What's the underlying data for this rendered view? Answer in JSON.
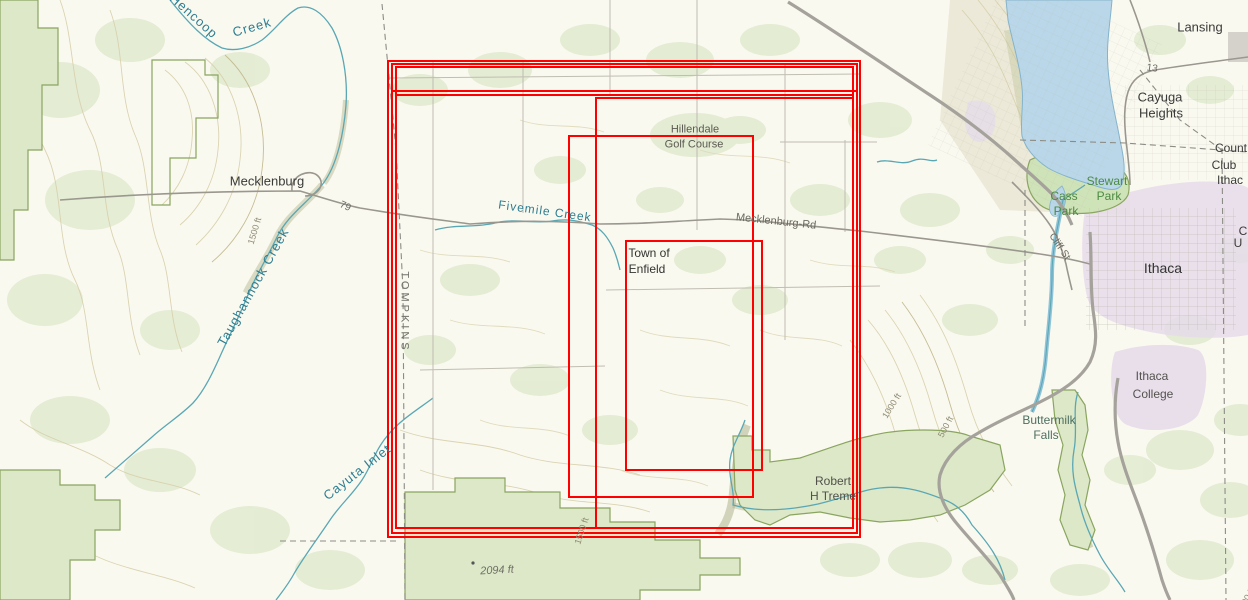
{
  "overlay": {
    "accent_color": "#ff0000",
    "rectangles": [
      {
        "x": 387,
        "y": 60,
        "w": 474,
        "h": 478
      },
      {
        "x": 391,
        "y": 63,
        "w": 467,
        "h": 471
      },
      {
        "x": 395,
        "y": 66,
        "w": 459,
        "h": 463
      },
      {
        "x": 391,
        "y": 90,
        "w": 467,
        "h": 444
      },
      {
        "x": 395,
        "y": 94,
        "w": 459,
        "h": 435
      },
      {
        "x": 595,
        "y": 97,
        "w": 259,
        "h": 432
      },
      {
        "x": 568,
        "y": 135,
        "w": 186,
        "h": 363
      },
      {
        "x": 625,
        "y": 240,
        "w": 138,
        "h": 231
      }
    ]
  },
  "basemap_colors": {
    "water": "#b9d7e8",
    "vegetation": "#e2ebd1",
    "park_outline": "#8aa55f",
    "contour": "#d7d0ab",
    "urban_tint": "#e6dcea",
    "road": "#a5a29b"
  },
  "labels": [
    {
      "id": "hencoop-creek-1",
      "text": "Hencoop",
      "x": 194,
      "y": 16,
      "rot": 42,
      "color": "#2e7d91",
      "size": 13,
      "spacing": 1
    },
    {
      "id": "hencoop-creek-2",
      "text": "Creek",
      "x": 252,
      "y": 27,
      "rot": -16,
      "color": "#2e7d91",
      "size": 13,
      "spacing": 1
    },
    {
      "id": "taughannock-creek",
      "text": "Taughannock Creek",
      "x": 253,
      "y": 287,
      "rot": -61,
      "color": "#2e7d91",
      "size": 13,
      "spacing": 1
    },
    {
      "id": "cayuta-inlet",
      "text": "Cayuta Inlet",
      "x": 357,
      "y": 472,
      "rot": -38,
      "color": "#2e7d91",
      "size": 13,
      "spacing": 1
    },
    {
      "id": "fivemile-creek",
      "text": "Fivemile Creek",
      "x": 545,
      "y": 211,
      "rot": 8,
      "color": "#2e7d91",
      "size": 12,
      "spacing": 1
    },
    {
      "id": "mecklenburg-town",
      "text": "Mecklenburg",
      "x": 267,
      "y": 181,
      "rot": 0,
      "color": "#3a3a38",
      "size": 13
    },
    {
      "id": "route-79",
      "text": "79",
      "x": 345,
      "y": 207,
      "rot": 24,
      "color": "#6a6a64",
      "size": 10
    },
    {
      "id": "route-13",
      "text": "13",
      "x": 1152,
      "y": 69,
      "rot": 8,
      "color": "#6a6a64",
      "size": 10
    },
    {
      "id": "mecklenburg-rd",
      "text": "Mecklenburg-Rd",
      "x": 776,
      "y": 222,
      "rot": 6,
      "color": "#6b6a60",
      "size": 11
    },
    {
      "id": "tompkins-county",
      "text": "TOMPKINS",
      "x": 404,
      "y": 312,
      "rot": 90,
      "color": "#71716a",
      "size": 11,
      "spacing": 3
    },
    {
      "id": "town-of",
      "text": "Town of",
      "x": 649,
      "y": 253,
      "rot": 0,
      "color": "#333330",
      "size": 12
    },
    {
      "id": "enfield",
      "text": "Enfield",
      "x": 647,
      "y": 269,
      "rot": 0,
      "color": "#333330",
      "size": 12
    },
    {
      "id": "hillendale",
      "text": "Hillendale",
      "x": 695,
      "y": 130,
      "rot": 0,
      "color": "#5a5951",
      "size": 11
    },
    {
      "id": "golf-course",
      "text": "Golf Course",
      "x": 694,
      "y": 145,
      "rot": 0,
      "color": "#5a5951",
      "size": 11
    },
    {
      "id": "robert",
      "text": "Robert",
      "x": 833,
      "y": 481,
      "rot": 0,
      "color": "#51514a",
      "size": 12
    },
    {
      "id": "h-treme",
      "text": "H Treme",
      "x": 833,
      "y": 496,
      "rot": 0,
      "color": "#51514a",
      "size": 12
    },
    {
      "id": "contour-1500-left",
      "text": "1500 ft",
      "x": 255,
      "y": 231,
      "rot": -73,
      "color": "#8e8b74",
      "size": 9
    },
    {
      "id": "contour-1000",
      "text": "1000 ft",
      "x": 892,
      "y": 406,
      "rot": -58,
      "color": "#8e8b74",
      "size": 9
    },
    {
      "id": "contour-500",
      "text": "500 ft",
      "x": 946,
      "y": 427,
      "rot": -62,
      "color": "#8e8b74",
      "size": 9
    },
    {
      "id": "contour-1500-bottom",
      "text": "1500 ft",
      "x": 582,
      "y": 531,
      "rot": -72,
      "color": "#8e8b74",
      "size": 9
    },
    {
      "id": "contour-1500-edge",
      "text": "1500 ft",
      "x": 1246,
      "y": 601,
      "rot": -60,
      "color": "#8e8b74",
      "size": 9
    },
    {
      "id": "spot-2094",
      "text": "2094 ft",
      "x": 497,
      "y": 571,
      "rot": -3,
      "color": "#6f6f65",
      "size": 11,
      "italic": true
    },
    {
      "id": "lansing",
      "text": "Lansing",
      "x": 1200,
      "y": 27,
      "rot": 0,
      "color": "#3a3a38",
      "size": 13
    },
    {
      "id": "cayuga",
      "text": "Cayuga",
      "x": 1160,
      "y": 97,
      "rot": 0,
      "color": "#3a3a38",
      "size": 13
    },
    {
      "id": "heights",
      "text": "Heights",
      "x": 1161,
      "y": 113,
      "rot": 0,
      "color": "#3a3a38",
      "size": 13
    },
    {
      "id": "ithaca",
      "text": "Ithaca",
      "x": 1163,
      "y": 268,
      "rot": 0,
      "color": "#333333",
      "size": 14
    },
    {
      "id": "stewart",
      "text": "Stewart",
      "x": 1107,
      "y": 181,
      "rot": 0,
      "color": "#4c8a42",
      "size": 12
    },
    {
      "id": "stewart-park",
      "text": "Park",
      "x": 1109,
      "y": 196,
      "rot": 0,
      "color": "#4c8a42",
      "size": 12
    },
    {
      "id": "cass",
      "text": "Cass",
      "x": 1064,
      "y": 196,
      "rot": 0,
      "color": "#4c8a42",
      "size": 12
    },
    {
      "id": "cass-park",
      "text": "Park",
      "x": 1066,
      "y": 211,
      "rot": 0,
      "color": "#4c8a42",
      "size": 12
    },
    {
      "id": "cliff-st",
      "text": "Cliff-St",
      "x": 1059,
      "y": 247,
      "rot": 56,
      "color": "#6b6a60",
      "size": 10
    },
    {
      "id": "country-club-1",
      "text": "Count",
      "x": 1231,
      "y": 148,
      "rot": 0,
      "color": "#3a3a38",
      "size": 12
    },
    {
      "id": "country-club-2",
      "text": "Club",
      "x": 1224,
      "y": 165,
      "rot": 0,
      "color": "#3a3a38",
      "size": 12
    },
    {
      "id": "country-club-3",
      "text": "Ithac",
      "x": 1230,
      "y": 180,
      "rot": 0,
      "color": "#3a3a38",
      "size": 12
    },
    {
      "id": "cornell-c",
      "text": "C",
      "x": 1243,
      "y": 231,
      "rot": 0,
      "color": "#3a3a38",
      "size": 12
    },
    {
      "id": "cornell-u",
      "text": "U",
      "x": 1238,
      "y": 243,
      "rot": 0,
      "color": "#3a3a38",
      "size": 12
    },
    {
      "id": "buttermilk",
      "text": "Buttermilk",
      "x": 1049,
      "y": 420,
      "rot": 0,
      "color": "#4e6f60",
      "size": 12
    },
    {
      "id": "falls",
      "text": "Falls",
      "x": 1046,
      "y": 435,
      "rot": 0,
      "color": "#4e6f60",
      "size": 12
    },
    {
      "id": "ithaca-college-1",
      "text": "Ithaca",
      "x": 1152,
      "y": 376,
      "rot": 0,
      "color": "#55524e",
      "size": 12
    },
    {
      "id": "ithaca-college-2",
      "text": "College",
      "x": 1153,
      "y": 394,
      "rot": 0,
      "color": "#55524e",
      "size": 12
    }
  ]
}
